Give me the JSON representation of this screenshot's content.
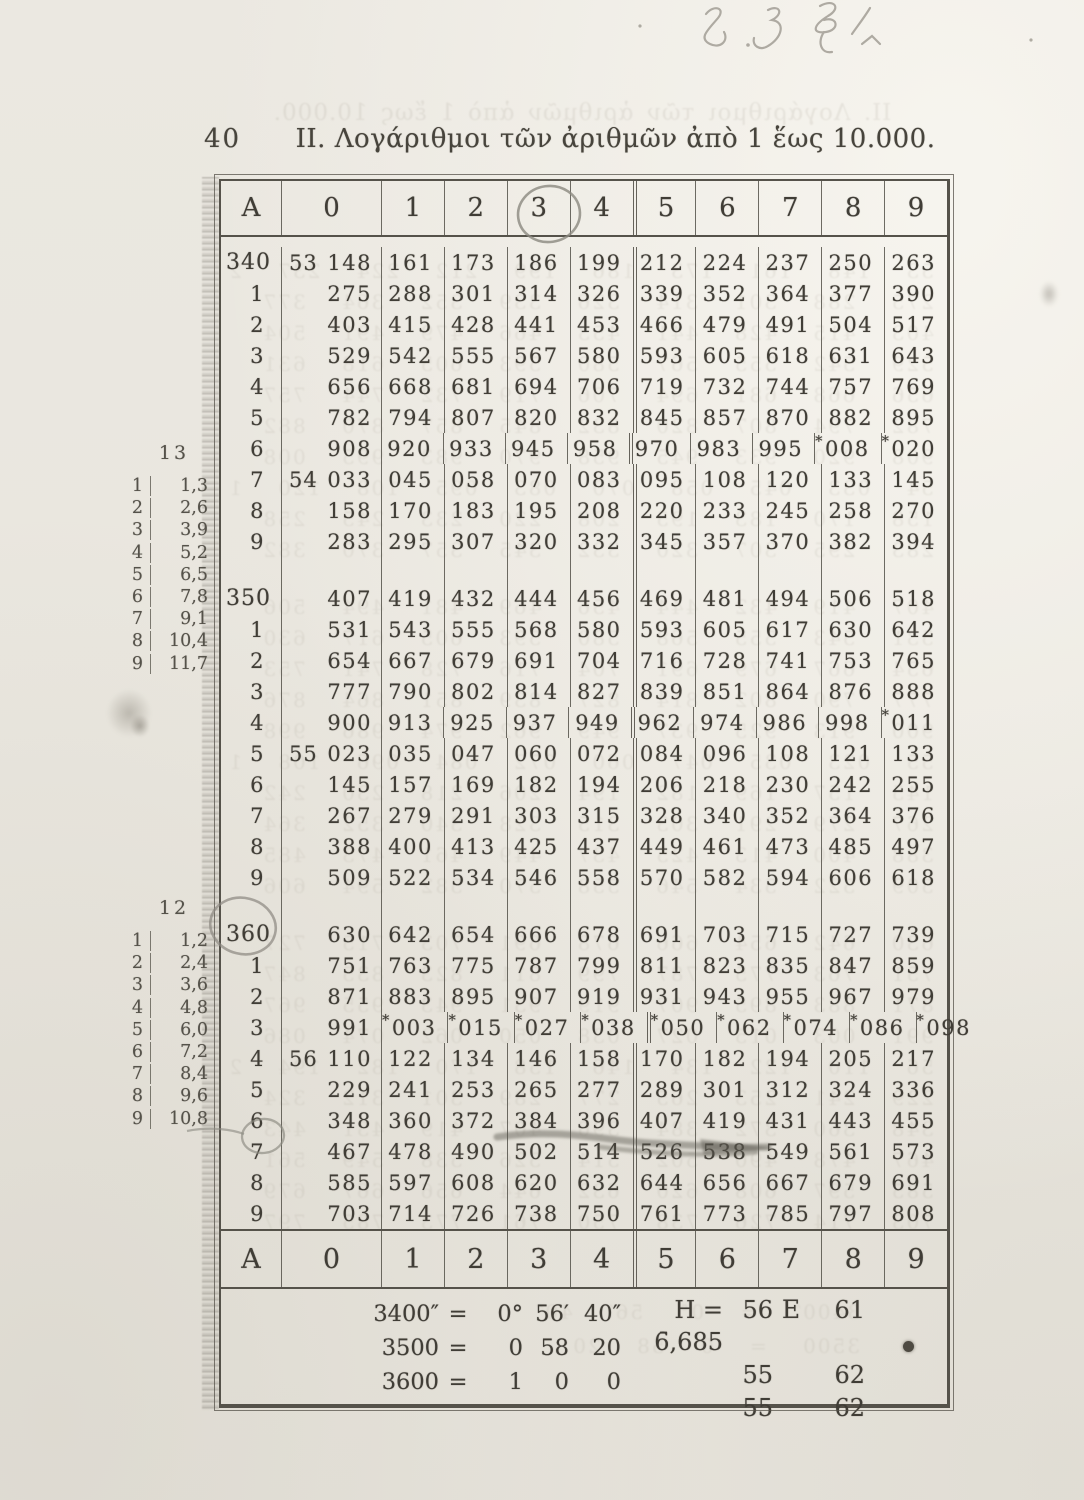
{
  "page": {
    "page_number": "40",
    "title": "II. Λογάριθμοι τῶν ἀριθμῶν ἀπὸ 1 ἕως 10.000."
  },
  "annotations": {
    "handwritten_note": "8.38.1",
    "circled_column_header": "3",
    "circled_row_block": "360",
    "circled_row_label": "7"
  },
  "table": {
    "column_headers": [
      "A",
      "0",
      "1",
      "2",
      "3",
      "4",
      "5",
      "6",
      "7",
      "8",
      "9"
    ],
    "blocks": [
      {
        "rows": [
          {
            "label": "340",
            "prefix": "53",
            "cells": [
              "148",
              "161",
              "173",
              "186",
              "199",
              "212",
              "224",
              "237",
              "250",
              "263"
            ]
          },
          {
            "label": "1",
            "prefix": "",
            "cells": [
              "275",
              "288",
              "301",
              "314",
              "326",
              "339",
              "352",
              "364",
              "377",
              "390"
            ]
          },
          {
            "label": "2",
            "prefix": "",
            "cells": [
              "403",
              "415",
              "428",
              "441",
              "453",
              "466",
              "479",
              "491",
              "504",
              "517"
            ]
          },
          {
            "label": "3",
            "prefix": "",
            "cells": [
              "529",
              "542",
              "555",
              "567",
              "580",
              "593",
              "605",
              "618",
              "631",
              "643"
            ]
          },
          {
            "label": "4",
            "prefix": "",
            "cells": [
              "656",
              "668",
              "681",
              "694",
              "706",
              "719",
              "732",
              "744",
              "757",
              "769"
            ]
          },
          {
            "label": "5",
            "prefix": "",
            "cells": [
              "782",
              "794",
              "807",
              "820",
              "832",
              "845",
              "857",
              "870",
              "882",
              "895"
            ]
          },
          {
            "label": "6",
            "prefix": "",
            "cells": [
              "908",
              "920",
              "933",
              "945",
              "958",
              "970",
              "983",
              "995",
              "*008",
              "*020"
            ]
          },
          {
            "label": "7",
            "prefix": "54",
            "cells": [
              "033",
              "045",
              "058",
              "070",
              "083",
              "095",
              "108",
              "120",
              "133",
              "145"
            ]
          },
          {
            "label": "8",
            "prefix": "",
            "cells": [
              "158",
              "170",
              "183",
              "195",
              "208",
              "220",
              "233",
              "245",
              "258",
              "270"
            ]
          },
          {
            "label": "9",
            "prefix": "",
            "cells": [
              "283",
              "295",
              "307",
              "320",
              "332",
              "345",
              "357",
              "370",
              "382",
              "394"
            ]
          }
        ]
      },
      {
        "rows": [
          {
            "label": "350",
            "prefix": "",
            "cells": [
              "407",
              "419",
              "432",
              "444",
              "456",
              "469",
              "481",
              "494",
              "506",
              "518"
            ]
          },
          {
            "label": "1",
            "prefix": "",
            "cells": [
              "531",
              "543",
              "555",
              "568",
              "580",
              "593",
              "605",
              "617",
              "630",
              "642"
            ]
          },
          {
            "label": "2",
            "prefix": "",
            "cells": [
              "654",
              "667",
              "679",
              "691",
              "704",
              "716",
              "728",
              "741",
              "753",
              "765"
            ]
          },
          {
            "label": "3",
            "prefix": "",
            "cells": [
              "777",
              "790",
              "802",
              "814",
              "827",
              "839",
              "851",
              "864",
              "876",
              "888"
            ]
          },
          {
            "label": "4",
            "prefix": "",
            "cells": [
              "900",
              "913",
              "925",
              "937",
              "949",
              "962",
              "974",
              "986",
              "998",
              "*011"
            ]
          },
          {
            "label": "5",
            "prefix": "55",
            "cells": [
              "023",
              "035",
              "047",
              "060",
              "072",
              "084",
              "096",
              "108",
              "121",
              "133"
            ]
          },
          {
            "label": "6",
            "prefix": "",
            "cells": [
              "145",
              "157",
              "169",
              "182",
              "194",
              "206",
              "218",
              "230",
              "242",
              "255"
            ]
          },
          {
            "label": "7",
            "prefix": "",
            "cells": [
              "267",
              "279",
              "291",
              "303",
              "315",
              "328",
              "340",
              "352",
              "364",
              "376"
            ]
          },
          {
            "label": "8",
            "prefix": "",
            "cells": [
              "388",
              "400",
              "413",
              "425",
              "437",
              "449",
              "461",
              "473",
              "485",
              "497"
            ]
          },
          {
            "label": "9",
            "prefix": "",
            "cells": [
              "509",
              "522",
              "534",
              "546",
              "558",
              "570",
              "582",
              "594",
              "606",
              "618"
            ]
          }
        ]
      },
      {
        "rows": [
          {
            "label": "360",
            "prefix": "",
            "cells": [
              "630",
              "642",
              "654",
              "666",
              "678",
              "691",
              "703",
              "715",
              "727",
              "739"
            ]
          },
          {
            "label": "1",
            "prefix": "",
            "cells": [
              "751",
              "763",
              "775",
              "787",
              "799",
              "811",
              "823",
              "835",
              "847",
              "859"
            ]
          },
          {
            "label": "2",
            "prefix": "",
            "cells": [
              "871",
              "883",
              "895",
              "907",
              "919",
              "931",
              "943",
              "955",
              "967",
              "979"
            ]
          },
          {
            "label": "3",
            "prefix": "",
            "cells": [
              "991",
              "*003",
              "*015",
              "*027",
              "*038",
              "*050",
              "*062",
              "*074",
              "*086",
              "*098"
            ]
          },
          {
            "label": "4",
            "prefix": "56",
            "cells": [
              "110",
              "122",
              "134",
              "146",
              "158",
              "170",
              "182",
              "194",
              "205",
              "217"
            ]
          },
          {
            "label": "5",
            "prefix": "",
            "cells": [
              "229",
              "241",
              "253",
              "265",
              "277",
              "289",
              "301",
              "312",
              "324",
              "336"
            ]
          },
          {
            "label": "6",
            "prefix": "",
            "cells": [
              "348",
              "360",
              "372",
              "384",
              "396",
              "407",
              "419",
              "431",
              "443",
              "455"
            ]
          },
          {
            "label": "7",
            "prefix": "",
            "cells": [
              "467",
              "478",
              "490",
              "502",
              "514",
              "526",
              "538",
              "549",
              "561",
              "573"
            ]
          },
          {
            "label": "8",
            "prefix": "",
            "cells": [
              "585",
              "597",
              "608",
              "620",
              "632",
              "644",
              "656",
              "667",
              "679",
              "691"
            ]
          },
          {
            "label": "9",
            "prefix": "",
            "cells": [
              "703",
              "714",
              "726",
              "738",
              "750",
              "761",
              "773",
              "785",
              "797",
              "808"
            ]
          }
        ]
      }
    ]
  },
  "proportional_parts": [
    {
      "diff": "13",
      "rows": [
        [
          "1",
          "1,3"
        ],
        [
          "2",
          "2,6"
        ],
        [
          "3",
          "3,9"
        ],
        [
          "4",
          "5,2"
        ],
        [
          "5",
          "6,5"
        ],
        [
          "6",
          "7,8"
        ],
        [
          "7",
          "9,1"
        ],
        [
          "8",
          "10,4"
        ],
        [
          "9",
          "11,7"
        ]
      ]
    },
    {
      "diff": "12",
      "rows": [
        [
          "1",
          "1,2"
        ],
        [
          "2",
          "2,4"
        ],
        [
          "3",
          "3,6"
        ],
        [
          "4",
          "4,8"
        ],
        [
          "5",
          "6,0"
        ],
        [
          "6",
          "7,2"
        ],
        [
          "7",
          "8,4"
        ],
        [
          "8",
          "9,6"
        ],
        [
          "9",
          "10,8"
        ]
      ]
    }
  ],
  "footer": {
    "conversion_rows": [
      [
        "3400″",
        "=",
        "0°",
        "56′",
        "40″"
      ],
      [
        "3500",
        "=",
        "0",
        "58",
        "20"
      ],
      [
        "3600",
        "=",
        "1",
        "0",
        "0"
      ]
    ],
    "h_rows": [
      [
        "H = 6̄,685",
        "56",
        "E",
        "61"
      ],
      [
        "",
        "55",
        "",
        "62"
      ],
      [
        "",
        "55",
        "",
        "62"
      ]
    ]
  }
}
